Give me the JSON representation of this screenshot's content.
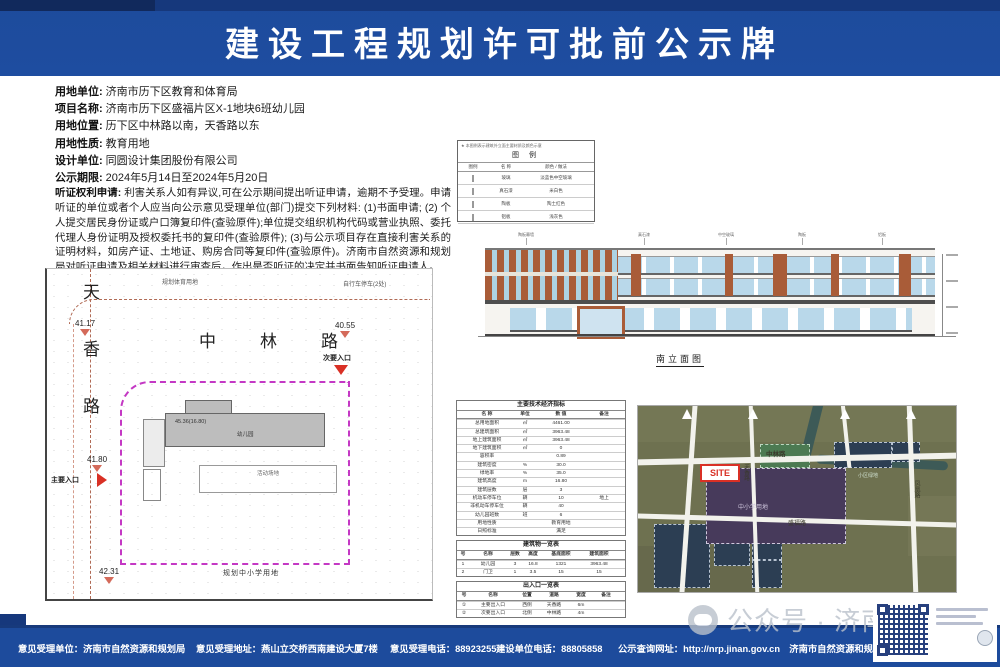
{
  "colors": {
    "header-blue": "#1d4b9c",
    "accent-red": "#d93025",
    "boundary-magenta": "#c438c4",
    "road-line": "#b06a55",
    "building-gray": "#bdbdbd",
    "facade-brown": "#a95c38",
    "window-blue": "#b9d8ea",
    "map-olive": "#6e7150",
    "map-purple": "#473a5b",
    "map-navy": "#2c3e53",
    "map-green": "#4c7a52"
  },
  "title": "建设工程规划许可批前公示牌",
  "info": {
    "fields": [
      {
        "label": "用地单位:",
        "value": "济南市历下区教育和体育局"
      },
      {
        "label": "项目名称:",
        "value": "济南市历下区盛福片区X-1地块6班幼儿园"
      },
      {
        "label": "用地位置:",
        "value": "历下区中林路以南，天香路以东"
      },
      {
        "label": "用地性质:",
        "value": "教育用地"
      },
      {
        "label": "设计单位:",
        "value": "同圆设计集团股份有限公司"
      },
      {
        "label": "公示期限:",
        "value": "2024年5月14日至2024年5月20日"
      }
    ],
    "hearing_label": "听证权利申请:",
    "hearing_text": "利害关系人如有异议,可在公示期间提出听证申请，逾期不予受理。申请听证的单位或者个人应当向公示意见受理单位(部门)提交下列材料: (1)书面申请; (2) 个人提交居民身份证或户口簿复印件(查验原件);单位提交组织机构代码或营业执照、委托代理人身份证明及授权委托书的复印件(查验原件); (3)与公示项目存在直接利害关系的证明材料，如房产证、土地证、购房合同等复印件(查验原件)。济南市自然资源和规划局对听证申请及相关材料进行审查后，作出是否听证的决定并书面告知听证申请人。"
  },
  "site_plan": {
    "road_vertical": "天香路",
    "road_horizontal": "中林路",
    "spots": [
      {
        "label": "41.17"
      },
      {
        "label": "40.55"
      },
      {
        "label": "41.80"
      },
      {
        "label": "42.31"
      }
    ],
    "entrance_secondary": "次要入口",
    "entrance_main": "主要入口",
    "label_top_left": "规划体育用地",
    "label_top_right": "自行车停车(2处)",
    "building_label_1": "45.36(16.80)",
    "building_label_2": "幼儿园",
    "playground_label": "活动场地",
    "label_bottom": "规划中小学用地"
  },
  "legend": {
    "note": "★ 本图例表示建筑外立面主要材质及颜色示意",
    "title": "图 例",
    "headers": [
      "图例",
      "名 称",
      "颜色 / 做法"
    ],
    "rows": [
      {
        "color": "#bcd7e6",
        "name": "玻璃",
        "desc": "淡蓝色中空玻璃"
      },
      {
        "color": "#f3efe8",
        "name": "真石漆",
        "desc": "米白色"
      },
      {
        "color": "#a8653f",
        "name": "陶板",
        "desc": "陶土红色"
      },
      {
        "color": "#c6c6c6",
        "name": "铝板",
        "desc": "浅灰色"
      }
    ]
  },
  "elevation": {
    "callouts": [
      "陶板幕墙",
      "真石漆",
      "中空玻璃",
      "陶板",
      "铝板"
    ],
    "caption": "南立面图"
  },
  "tables": {
    "indicators": {
      "title": "主要技术经济指标",
      "headers": [
        "名 称",
        "单位",
        "数 值",
        "备注"
      ],
      "rows": [
        [
          "总用地面积",
          "㎡",
          "4461.00",
          ""
        ],
        [
          "总建筑面积",
          "㎡",
          "3963.48",
          ""
        ],
        [
          "地上建筑面积",
          "㎡",
          "3963.48",
          ""
        ],
        [
          "地下建筑面积",
          "㎡",
          "0",
          ""
        ],
        [
          "容积率",
          "",
          "0.89",
          ""
        ],
        [
          "建筑密度",
          "%",
          "30.0",
          ""
        ],
        [
          "绿地率",
          "%",
          "35.0",
          ""
        ],
        [
          "建筑高度",
          "m",
          "16.80",
          ""
        ],
        [
          "建筑层数",
          "层",
          "3",
          ""
        ],
        [
          "机动车停车位",
          "辆",
          "10",
          "地上"
        ],
        [
          "非机动车停车位",
          "辆",
          "40",
          ""
        ],
        [
          "幼儿园班数",
          "班",
          "6",
          ""
        ],
        [
          "用地性质",
          "",
          "教育用地",
          ""
        ],
        [
          "日照标准",
          "",
          "满足",
          ""
        ]
      ]
    },
    "buildings": {
      "title": "建筑物一览表",
      "headers": [
        "号",
        "名称",
        "层数",
        "高度",
        "基底面积",
        "建筑面积"
      ],
      "rows": [
        [
          "1",
          "幼儿园",
          "3",
          "16.8",
          "1321",
          "3963.48"
        ],
        [
          "2",
          "门卫",
          "1",
          "3.5",
          "15",
          "15"
        ]
      ]
    },
    "entrances": {
      "title": "出入口一览表",
      "headers": [
        "号",
        "名称",
        "位置",
        "道路",
        "宽度",
        "备注"
      ],
      "rows": [
        [
          "①",
          "主要出入口",
          "西侧",
          "天香路",
          "6m",
          ""
        ],
        [
          "②",
          "次要出入口",
          "北侧",
          "中林路",
          "4m",
          ""
        ]
      ]
    }
  },
  "map": {
    "site_tag": "SITE",
    "labels": [
      {
        "text": "中林路"
      },
      {
        "text": "中小学用地"
      },
      {
        "text": "凤凰路"
      },
      {
        "text": "盛福路"
      },
      {
        "text": "小区绿地"
      },
      {
        "text": "天香路"
      }
    ]
  },
  "footer": {
    "items": [
      "意见受理单位：济南市自然资源和规划局",
      "意见受理地址：燕山立交桥西南建设大厦7楼",
      "意见受理电话：88923255",
      "建设单位电话：88805858",
      "公示查询网址：http://nrp.jinan.gov.cn　济南市自然资源和规划局监制"
    ]
  },
  "watermark": {
    "text": "公众号 · 济南时报"
  }
}
